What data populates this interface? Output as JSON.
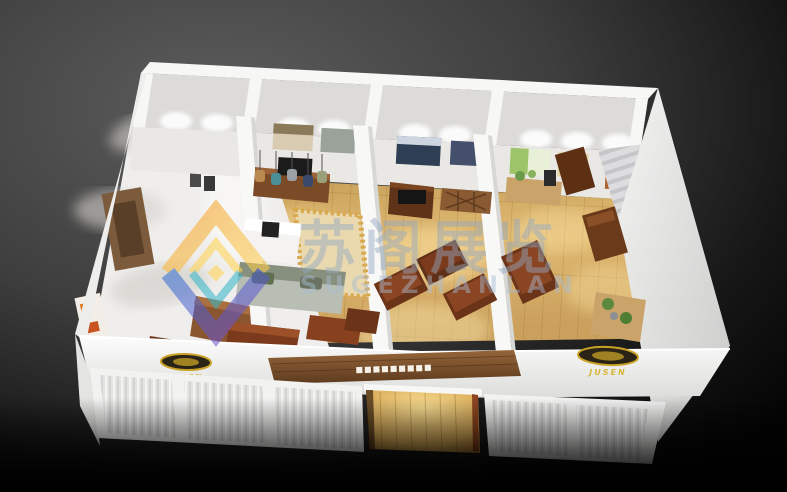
{
  "meta": {
    "title": "3D exhibition booth rendering",
    "image_type": "3d-render",
    "description": "Isometric top-down 3D render of a white exhibition booth containing furniture showroom rooms with wooden floors, sofas, cabinets and display benches, on a dark vignetted background"
  },
  "palette": {
    "background_top": "#5d5d5d",
    "background_bottom": "#040404",
    "wall_white": "#f6f6f5",
    "floor_wood": "#d8b06a",
    "entrance_glow": "#f2cf82",
    "furniture_wood_dark": "#5f3317",
    "furniture_wood_red": "#7c3a1c",
    "sign_wood": "#7a4f2a",
    "emblem_gold": "#c9a227",
    "watermark_text": "#93a9c2",
    "logo_orange": "#f59b20",
    "logo_yellow": "#ffd34e",
    "logo_blue": "#2f6fd0",
    "logo_purple": "#7a4fd0",
    "logo_teal": "#35b6c9"
  },
  "watermark": {
    "chinese": "苏阁展览",
    "latin": "SUGEZHANLAN"
  },
  "booth": {
    "sign": {
      "text": "■■■■■■■■■"
    },
    "emblems": {
      "left_label": "JUSEN",
      "right_label": "JUSEN"
    }
  }
}
